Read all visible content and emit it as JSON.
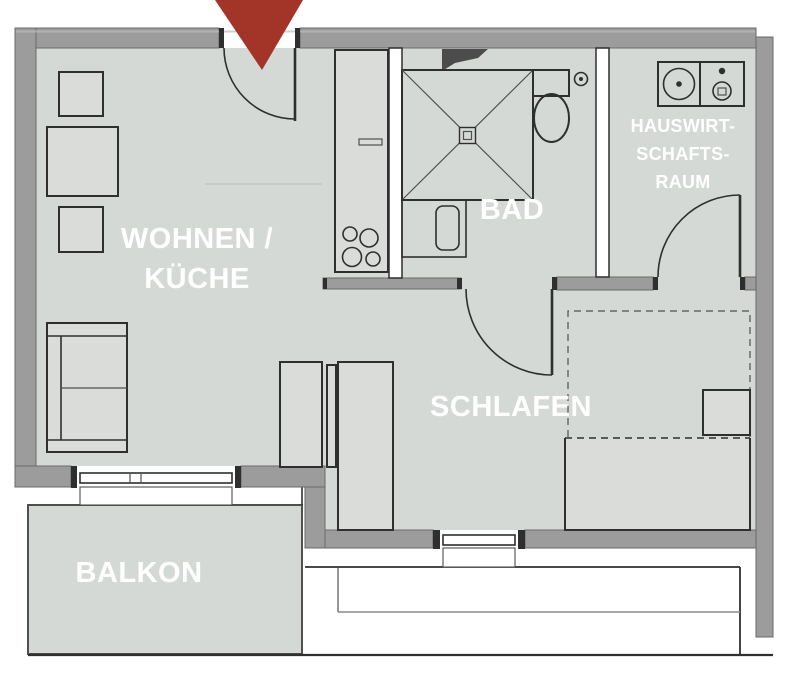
{
  "colors": {
    "bg": "#ffffff",
    "floor": "#d5d9d6",
    "furniture": "#d9dcd9",
    "wall": "#9c9c9c",
    "wall-edge": "#6a6a6a",
    "line": "#2f2f2f",
    "line-soft": "#4f4f4f",
    "wedge": "#4c4c4c",
    "accent": "#a23428",
    "label": "#ffffff"
  },
  "rooms": {
    "living_kitchen": {
      "line1": "WOHNEN /",
      "line2": "KÜCHE"
    },
    "bathroom": {
      "label": "BAD"
    },
    "utility_room": {
      "line1": "HAUSWIRT-",
      "line2": "SCHAFTS-",
      "line3": "RAUM"
    },
    "bedroom": {
      "label": "SCHLAFEN"
    },
    "balcony": {
      "label": "BALKON"
    }
  },
  "icons": {
    "entrance": "entrance-arrow-icon",
    "shower": "shower-icon",
    "toilet": "toilet-icon",
    "washbasin": "washbasin-icon",
    "stove": "stove-icon",
    "washing_machine": "washing-machine-icon",
    "sofa": "sofa-icon",
    "dining_table": "dining-table-icon",
    "chair": "chair-icon",
    "sideboard": "sideboard-icon",
    "wardrobe": "wardrobe-icon",
    "bed": "bed-icon",
    "nightstand": "nightstand-icon"
  }
}
